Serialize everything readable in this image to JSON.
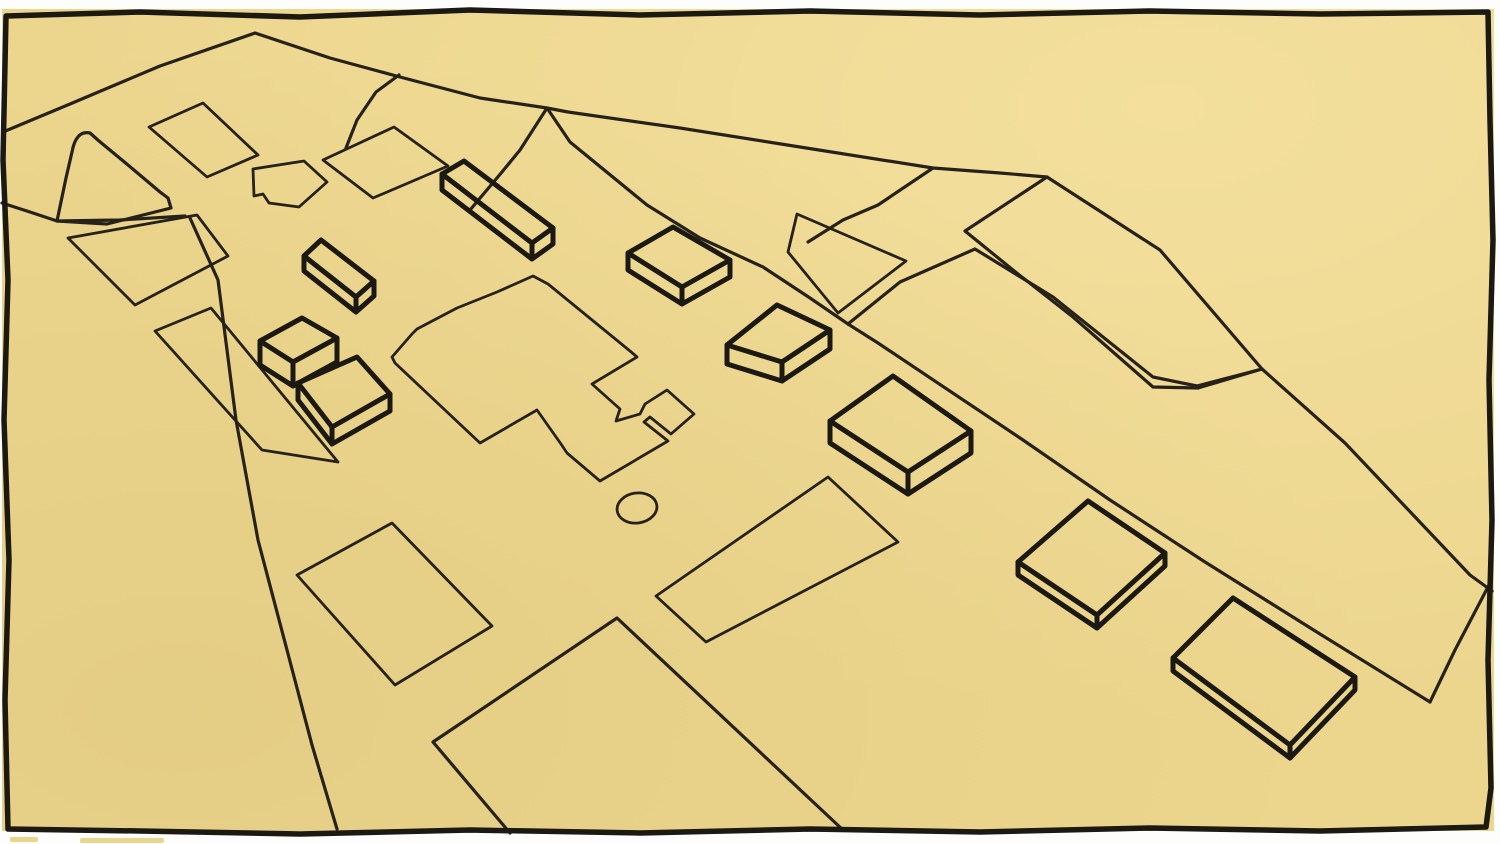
{
  "meta": {
    "description": "Hand-drawn ink sketch on yellow paper: aerial perspective site plan with roads, flat parcels and extruded building blocks",
    "canvas_width": 1500,
    "canvas_height": 844
  },
  "palette": {
    "margin": "#fdfdfb",
    "paper": "#ecd68e",
    "paper_bright": "#f5e1a0",
    "paper_shade": "#e2cb81",
    "ink": "#262219",
    "ink_heavy": "#1b1912",
    "smudge": "#e6ca72"
  },
  "stroke_widths": {
    "thin": 2.8,
    "road": 3.2,
    "heavy": 5,
    "border": 5.5
  },
  "sketch": {
    "border": {
      "name": "page-border",
      "d": "M6 16 L140 12 L300 17 L470 10 L640 15 L810 11 L980 15 L1150 11 L1320 14 L1488 12 L1490 120 L1493 240 L1489 380 L1492 520 L1488 660 L1491 788 L1486 827 L1320 831 L1150 828 L980 832 L810 829 L640 833 L470 830 L300 834 L140 831 L8 829 L5 700 L9 560 L4 420 L8 280 L3 160 Z"
    },
    "lines": [
      {
        "name": "site-boundary-line",
        "w": "road",
        "pts": [
          [
            3,
            132
          ],
          [
            70,
            104
          ],
          [
            160,
            66
          ],
          [
            255,
            33
          ],
          [
            330,
            58
          ],
          [
            400,
            77
          ],
          [
            480,
            98
          ],
          [
            547,
            108
          ],
          [
            568,
            112
          ],
          [
            680,
            128
          ],
          [
            800,
            147
          ],
          [
            933,
            168
          ],
          [
            1000,
            173
          ],
          [
            1047,
            177
          ]
        ]
      },
      {
        "name": "right-boundary-road-line",
        "w": "road",
        "pts": [
          [
            1047,
            177
          ],
          [
            1160,
            250
          ],
          [
            1262,
            369
          ],
          [
            1345,
            443
          ],
          [
            1470,
            575
          ],
          [
            1492,
            591
          ]
        ]
      },
      {
        "name": "bottom-right-corner-line",
        "w": "road",
        "pts": [
          [
            1489,
            585
          ],
          [
            1455,
            650
          ],
          [
            1430,
            702
          ]
        ]
      },
      {
        "name": "central-road-left-edge",
        "w": "road",
        "pts": [
          [
            848,
            324
          ],
          [
            878,
            343
          ],
          [
            1023,
            440
          ],
          [
            1110,
            500
          ],
          [
            1205,
            562
          ],
          [
            1320,
            634
          ],
          [
            1430,
            702
          ]
        ]
      },
      {
        "name": "pointed-parcel-upper-edge",
        "w": "road",
        "pts": [
          [
            1047,
            177
          ],
          [
            965,
            231
          ],
          [
            1013,
            270
          ],
          [
            1073,
            317
          ],
          [
            1153,
            387
          ],
          [
            1198,
            388
          ]
        ]
      },
      {
        "name": "pointed-parcel-lower-edge",
        "w": "road",
        "pts": [
          [
            848,
            324
          ],
          [
            900,
            282
          ],
          [
            975,
            249
          ],
          [
            1053,
            297
          ],
          [
            1153,
            377
          ],
          [
            1197,
            386
          ],
          [
            1262,
            369
          ]
        ]
      },
      {
        "name": "road-junction-connector",
        "w": "road",
        "pts": [
          [
            1198,
            388
          ],
          [
            1262,
            369
          ]
        ]
      },
      {
        "name": "wedge-road-edge",
        "w": "road",
        "pts": [
          [
            547,
            108
          ],
          [
            570,
            142
          ],
          [
            647,
            205
          ],
          [
            700,
            238
          ],
          [
            763,
            267
          ],
          [
            810,
            298
          ],
          [
            848,
            324
          ]
        ]
      },
      {
        "name": "wedge-left-road-edge",
        "w": "road",
        "pts": [
          [
            547,
            108
          ],
          [
            520,
            150
          ],
          [
            502,
            172
          ],
          [
            470,
            210
          ]
        ]
      },
      {
        "name": "upper-left-road-edge",
        "w": "road",
        "pts": [
          [
            399,
            75
          ],
          [
            376,
            92
          ],
          [
            357,
            120
          ],
          [
            346,
            148
          ]
        ]
      },
      {
        "name": "upper-right-road-spur",
        "w": "road",
        "pts": [
          [
            933,
            168
          ],
          [
            878,
            205
          ],
          [
            843,
            220
          ],
          [
            808,
            242
          ]
        ]
      },
      {
        "name": "left-road-base-line",
        "w": "road",
        "pts": [
          [
            2,
            203
          ],
          [
            30,
            212
          ],
          [
            57,
            221
          ],
          [
            120,
            220
          ],
          [
            185,
            216
          ]
        ]
      },
      {
        "name": "left-curved-road-edge",
        "w": "road",
        "pts": [
          [
            190,
            218
          ],
          [
            218,
            280
          ],
          [
            236,
            420
          ],
          [
            258,
            540
          ],
          [
            287,
            650
          ],
          [
            312,
            745
          ],
          [
            337,
            829
          ]
        ]
      },
      {
        "name": "bottom-parcel-outline",
        "w": "road",
        "pts": [
          [
            510,
            833
          ],
          [
            433,
            742
          ],
          [
            617,
            618
          ],
          [
            843,
            830
          ]
        ]
      }
    ],
    "parcels": [
      {
        "name": "parcel-top-left",
        "pts": [
          [
            149,
            127
          ],
          [
            203,
            103
          ],
          [
            258,
            155
          ],
          [
            207,
            177
          ]
        ]
      },
      {
        "name": "parcel-notched-small",
        "pts": [
          [
            253,
            169
          ],
          [
            304,
            161
          ],
          [
            327,
            182
          ],
          [
            299,
            207
          ],
          [
            269,
            203
          ],
          [
            263,
            194
          ],
          [
            254,
            196
          ]
        ]
      },
      {
        "name": "parcel-diamond-upper",
        "pts": [
          [
            394,
            127
          ],
          [
            448,
            166
          ],
          [
            373,
            198
          ],
          [
            323,
            160
          ]
        ]
      },
      {
        "name": "parcel-bottom-left-large",
        "pts": [
          [
            68,
            238
          ],
          [
            197,
            215
          ],
          [
            228,
            256
          ],
          [
            135,
            305
          ]
        ]
      },
      {
        "name": "parcel-long-strip",
        "pts": [
          [
            155,
            331
          ],
          [
            211,
            308
          ],
          [
            338,
            462
          ],
          [
            262,
            450
          ]
        ]
      },
      {
        "name": "parcel-upper-right-small",
        "pts": [
          [
            797,
            214
          ],
          [
            906,
            261
          ],
          [
            838,
            313
          ],
          [
            788,
            252
          ]
        ]
      },
      {
        "name": "parcel-bottom-center-diamond",
        "pts": [
          [
            392,
            523
          ],
          [
            492,
            626
          ],
          [
            395,
            685
          ],
          [
            297,
            575
          ]
        ]
      },
      {
        "name": "parcel-bottom-long-strip",
        "pts": [
          [
            828,
            477
          ],
          [
            898,
            542
          ],
          [
            706,
            642
          ],
          [
            656,
            596
          ]
        ]
      }
    ],
    "paths": [
      {
        "name": "hill-plot-rounded-triangle",
        "w": "road",
        "d": "M57 221 L66 178 L72 152 Q76 130 90 133 L99 141 L128 165 L160 192 L168 198 L171 208 L107 224 Z"
      },
      {
        "name": "building-footprint-irregular",
        "w": "thin",
        "d": "M533 276 L548 284 L630 351 L637 357 L592 384 L620 409 L616 421 L640 414 L645 404 L667 390 L694 414 L671 434 L650 417 L644 422 L668 441 L600 481 L567 453 L561 444 L537 410 L480 443 L395 363 L392 357 L412 334 L417 329 L457 308 L497 292 Z"
      }
    ],
    "ellipses": [
      {
        "name": "round-feature",
        "cx": 637,
        "cy": 508,
        "rx": 20,
        "ry": 15,
        "rot": -8
      }
    ],
    "boxes": [
      {
        "name": "building-box-long-upper",
        "top": [
          [
            442,
            174
          ],
          [
            464,
            161
          ],
          [
            553,
            228
          ],
          [
            532,
            243
          ]
        ],
        "h": 16
      },
      {
        "name": "building-box-small-thin",
        "top": [
          [
            304,
            256
          ],
          [
            321,
            240
          ],
          [
            374,
            281
          ],
          [
            356,
            297
          ]
        ],
        "h": 15
      },
      {
        "name": "building-box-center-upper",
        "top": [
          [
            628,
            253
          ],
          [
            673,
            227
          ],
          [
            730,
            260
          ],
          [
            682,
            287
          ]
        ],
        "h": 17
      },
      {
        "name": "building-box-pair-upper",
        "top": [
          [
            260,
            341
          ],
          [
            302,
            318
          ],
          [
            337,
            338
          ],
          [
            293,
            362
          ]
        ],
        "h": 24
      },
      {
        "name": "building-box-pair-lower",
        "top": [
          [
            298,
            383
          ],
          [
            357,
            357
          ],
          [
            390,
            394
          ],
          [
            332,
            427
          ]
        ],
        "h": 17
      },
      {
        "name": "building-box-center-mid",
        "top": [
          [
            727,
            345
          ],
          [
            777,
            305
          ],
          [
            830,
            330
          ],
          [
            782,
            362
          ]
        ],
        "h": 19
      },
      {
        "name": "building-box-center-right",
        "top": [
          [
            830,
            421
          ],
          [
            893,
            376
          ],
          [
            971,
            431
          ],
          [
            908,
            472
          ]
        ],
        "h": 22
      },
      {
        "name": "building-box-lower-right-a",
        "top": [
          [
            1018,
            562
          ],
          [
            1088,
            501
          ],
          [
            1165,
            553
          ],
          [
            1097,
            615
          ]
        ],
        "h": 13
      },
      {
        "name": "building-box-lower-right-b",
        "top": [
          [
            1173,
            658
          ],
          [
            1233,
            598
          ],
          [
            1355,
            677
          ],
          [
            1290,
            745
          ]
        ],
        "h": 13
      }
    ],
    "smudges": [
      {
        "name": "paper-smudge-1",
        "x": 10,
        "y": 837,
        "w": 28,
        "h": 5
      },
      {
        "name": "paper-smudge-2",
        "x": 80,
        "y": 838,
        "w": 84,
        "h": 5
      }
    ]
  }
}
